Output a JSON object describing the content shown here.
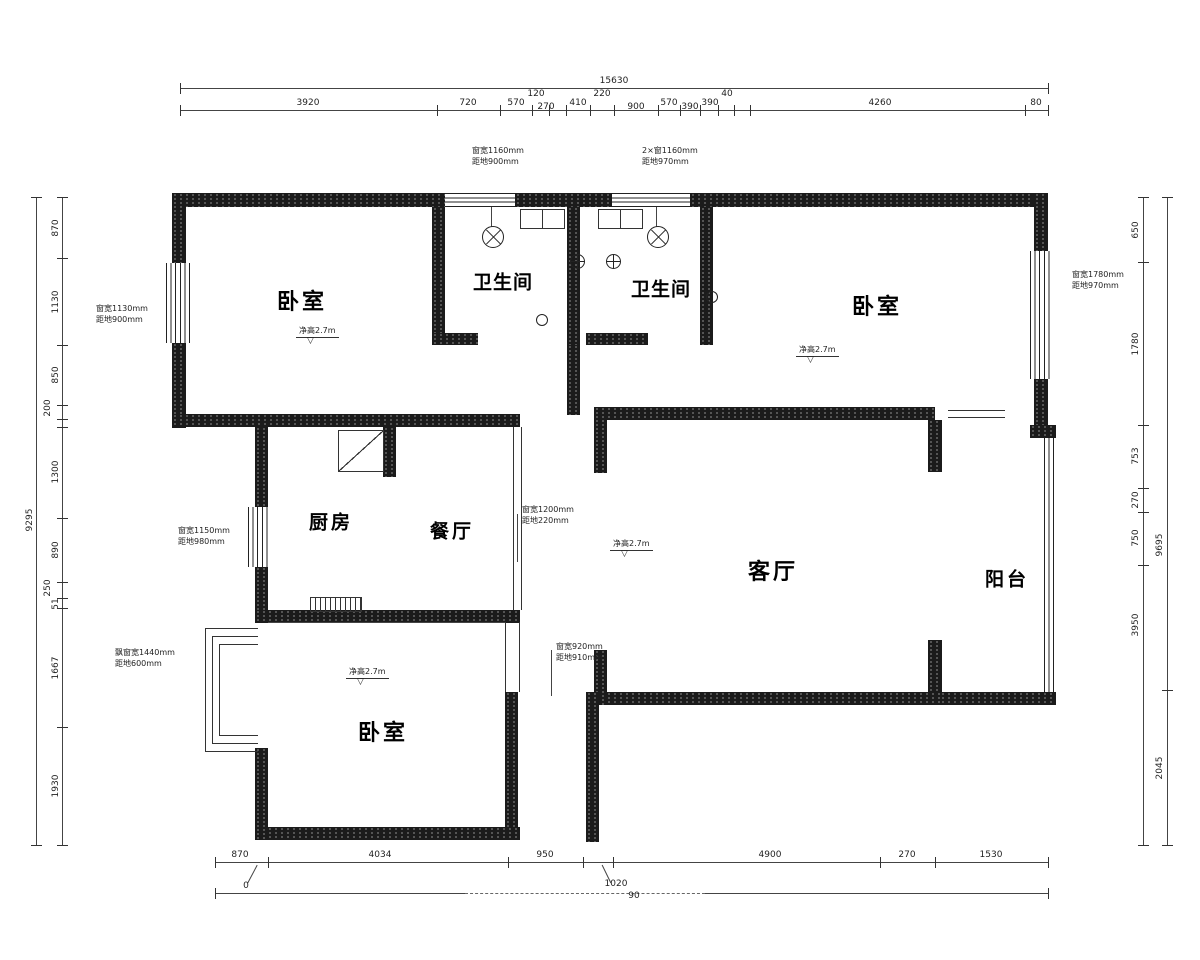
{
  "icons": {
    "elevation_triangle": "▽"
  },
  "rooms": {
    "bedroom_top_left": "卧室",
    "bath_left": "卫生间",
    "bath_right": "卫生间",
    "bedroom_top_right": "卧室",
    "kitchen": "厨房",
    "dining": "餐厅",
    "living": "客厅",
    "balcony": "阳台",
    "bedroom_bottom": "卧室"
  },
  "elevation_marks": {
    "m1": "净高2.7m",
    "m2": "净高2.7m",
    "m3": "净高2.7m",
    "m4": "净高2.7m"
  },
  "window_notes": {
    "n1": {
      "line1": "窗宽1160mm",
      "line2": "距地900mm"
    },
    "n2": {
      "line1": "2×窗1160mm",
      "line2": "距地970mm"
    },
    "n3": {
      "line1": "窗宽1130mm",
      "line2": "距地900mm"
    },
    "n4": {
      "line1": "窗宽1780mm",
      "line2": "距地970mm"
    },
    "n5": {
      "line1": "窗宽1150mm",
      "line2": "距地980mm"
    },
    "n6": {
      "line1": "飘窗宽1440mm",
      "line2": "距地600mm"
    },
    "n7": {
      "line1": "窗宽1200mm",
      "line2": "距地220mm"
    },
    "n8": {
      "line1": "窗宽920mm",
      "line2": "距地910mm"
    }
  },
  "dims": {
    "top_total": "15630",
    "top": [
      "3920",
      "720",
      "570",
      "120",
      "270",
      "410",
      "220",
      "900",
      "570",
      "390",
      "390",
      "40",
      "4260",
      "80"
    ],
    "left": [
      "870",
      "1130",
      "850",
      "200",
      "1300",
      "890",
      "250",
      "51",
      "1667",
      "1930"
    ],
    "left_total": "9295",
    "right": [
      "650",
      "1780",
      "753",
      "270",
      "750",
      "3950"
    ],
    "right_total": "9695",
    "right_bottom": "2045",
    "bottom": [
      "870",
      "4034",
      "950",
      "4900",
      "270",
      "1530"
    ],
    "bottom_leaders": [
      "0",
      "1020",
      "90"
    ]
  }
}
